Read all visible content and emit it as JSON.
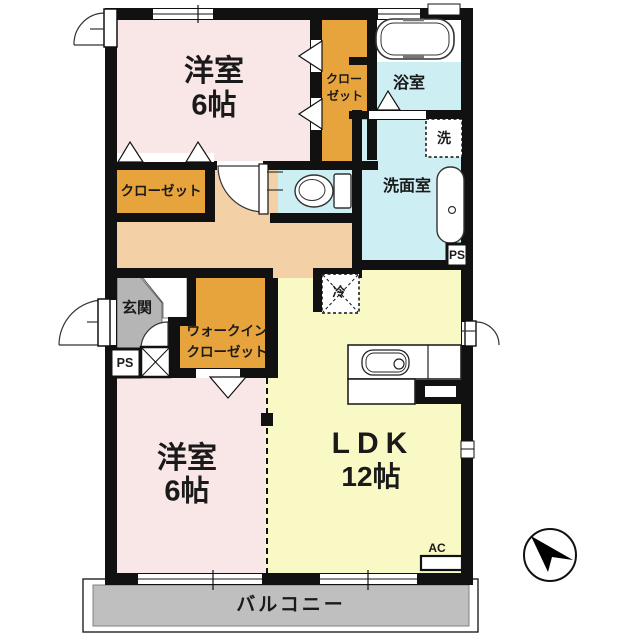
{
  "rooms": {
    "bedroom_top": {
      "name": "洋室",
      "size": "6帖"
    },
    "closet_top": {
      "line1": "クロー",
      "line2": "ゼット"
    },
    "bath": {
      "name": "浴室"
    },
    "laundry": {
      "symbol": "洗"
    },
    "washroom": {
      "name": "洗面室"
    },
    "closet_hall": {
      "name": "クローゼット"
    },
    "entrance": {
      "name": "玄関"
    },
    "walk_in_closet": {
      "line1": "ウォークイン",
      "line2": "クローゼット"
    },
    "refrigerator": {
      "symbol": "冷"
    },
    "bedroom_bottom": {
      "name": "洋室",
      "size": "6帖"
    },
    "ldk": {
      "name": "LDK",
      "size": "12帖"
    },
    "balcony": {
      "name": "バルコニー"
    }
  },
  "labels": {
    "ps_entrance": "PS",
    "ps_washroom": "PS",
    "air_conditioner": "AC"
  },
  "colors": {
    "room_pink": "#f9e6e6",
    "closet_orange": "#e7a43c",
    "water_cyan": "#cdeef2",
    "hall_peach": "#f4d0a6",
    "ldk_yellow": "#f9f9c5",
    "entrance_gray": "#b5b5b5",
    "balcony_gray": "#bfbfbf",
    "wall": "#111111"
  }
}
